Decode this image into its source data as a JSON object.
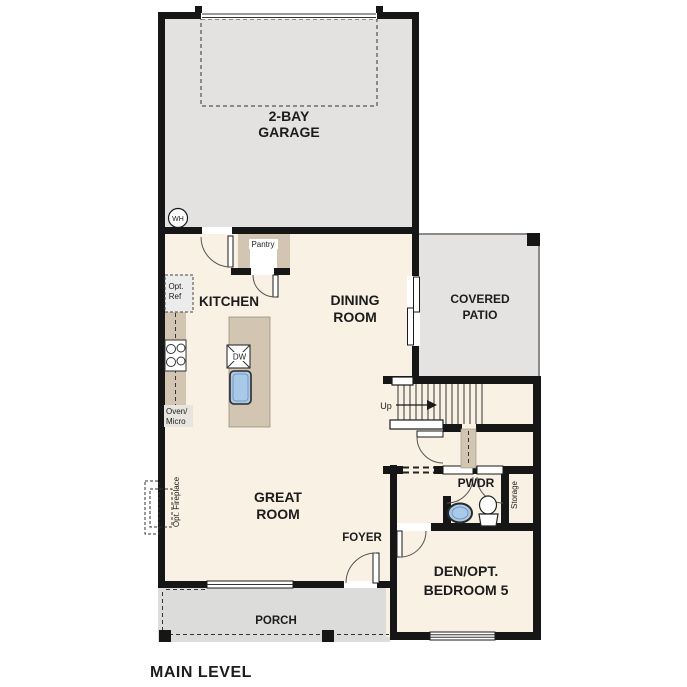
{
  "title": "MAIN LEVEL",
  "colors": {
    "wall": "#161616",
    "floor": "#f8f1e4",
    "garage_fill": "#e3e2e0",
    "patio_fill": "#e4e3e1",
    "porch_fill": "#dcdcda",
    "cabinet_fill": "#d2c6b2",
    "sink_fill": "#a9c9e8"
  },
  "rooms": {
    "garage": {
      "line1": "2-BAY",
      "line2": "GARAGE"
    },
    "kitchen": {
      "label": "KITCHEN"
    },
    "dining": {
      "line1": "DINING",
      "line2": "ROOM"
    },
    "patio": {
      "line1": "COVERED",
      "line2": "PATIO"
    },
    "great": {
      "line1": "GREAT",
      "line2": "ROOM"
    },
    "foyer": {
      "label": "FOYER"
    },
    "porch": {
      "label": "PORCH"
    },
    "pwdr": {
      "label": "PWDR"
    },
    "storage": {
      "label": "Storage"
    },
    "den": {
      "line1": "DEN/OPT.",
      "line2": "BEDROOM 5"
    },
    "pantry": {
      "label": "Pantry"
    }
  },
  "fixtures": {
    "water_heater": "WH",
    "dishwasher": "DW",
    "opt_ref_line1": "Opt.",
    "opt_ref_line2": "Ref",
    "oven_line1": "Oven/",
    "oven_line2": "Micro",
    "opt_fireplace": "Opt. Fireplace",
    "stairs_up": "Up"
  }
}
